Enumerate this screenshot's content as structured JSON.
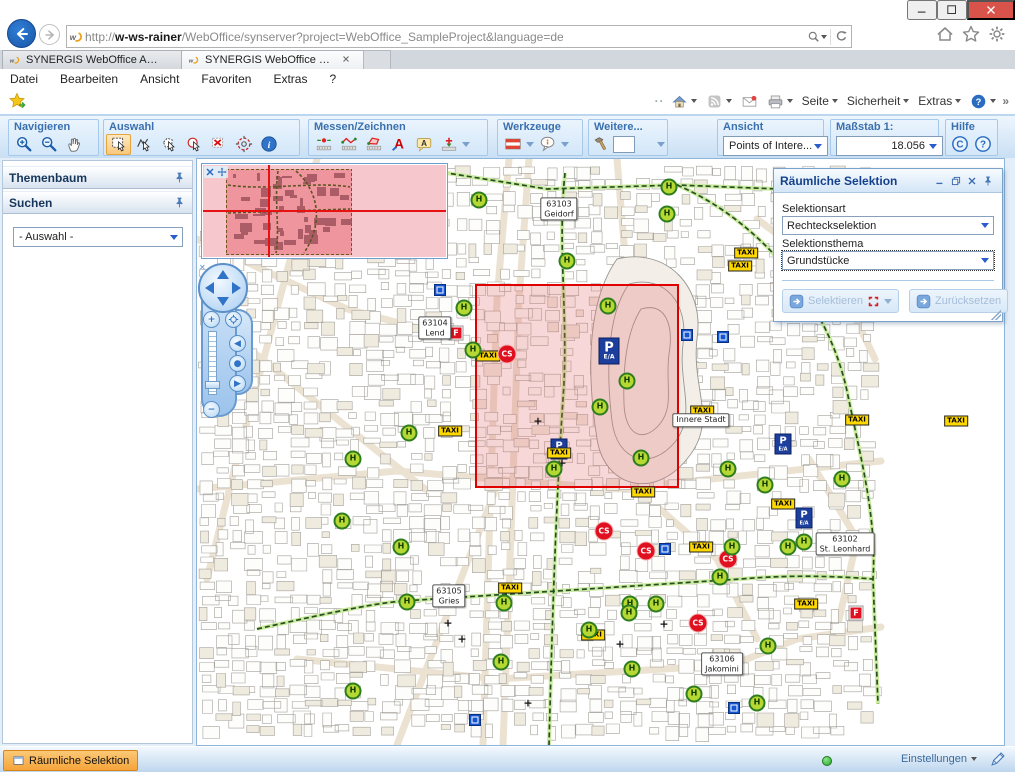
{
  "browser": {
    "url": {
      "scheme": "http://",
      "host": "w-ws-rainer",
      "path": "/WebOffice/synserver?project=WebOffice_SampleProject&language=de"
    },
    "tabs": [
      {
        "label": "SYNERGIS WebOffice Administ...",
        "active": false
      },
      {
        "label": "SYNERGIS WebOffice WebO...",
        "active": true
      }
    ],
    "menu": [
      "Datei",
      "Bearbeiten",
      "Ansicht",
      "Favoriten",
      "Extras",
      "?"
    ],
    "command_items": [
      {
        "icon": "home-icon",
        "caret": true
      },
      {
        "icon": "feeds-icon",
        "caret": true
      },
      {
        "icon": "read-mail-icon",
        "caret": false
      },
      {
        "icon": "print-icon",
        "caret": true
      },
      {
        "label": "Seite",
        "caret": true
      },
      {
        "label": "Sicherheit",
        "caret": true
      },
      {
        "label": "Extras",
        "caret": true
      },
      {
        "icon": "help-badge-icon",
        "caret": true
      }
    ],
    "overflow_chevron": "»",
    "drag_dots": "··"
  },
  "toolbar": {
    "groups": [
      {
        "label": "Navigieren",
        "icons": [
          {
            "name": "zoom-in-icon"
          },
          {
            "name": "zoom-out-icon"
          },
          {
            "name": "pan-icon"
          }
        ]
      },
      {
        "label": "Auswahl",
        "icons": [
          {
            "name": "select-rectangle-icon",
            "active": true
          },
          {
            "name": "select-line-icon"
          },
          {
            "name": "select-polygon-icon"
          },
          {
            "name": "select-circle-icon"
          },
          {
            "name": "select-clear-icon"
          },
          {
            "name": "select-buffer-icon"
          },
          {
            "name": "identify-icon"
          }
        ]
      },
      {
        "label": "Messen/Zeichnen",
        "icons": [
          {
            "name": "measure-point-icon"
          },
          {
            "name": "measure-line-icon"
          },
          {
            "name": "measure-area-icon"
          },
          {
            "name": "draw-text-icon"
          },
          {
            "name": "draw-label-icon"
          },
          {
            "name": "draw-symbol-icon",
            "caret": true
          }
        ]
      },
      {
        "label": "Werkzeuge",
        "icons": [
          {
            "name": "austria-flag-icon",
            "caret": true
          },
          {
            "name": "maptip-icon",
            "caret": true
          }
        ]
      },
      {
        "label": "Weitere...",
        "icons": [
          {
            "name": "hammer-icon"
          },
          {
            "name": "tool-text-input",
            "input": true
          },
          {
            "name": "more-tools",
            "caret": true
          }
        ]
      },
      {
        "label": "Ansicht",
        "dropdown": "Points of Intere..."
      },
      {
        "label": "Maßstab 1:",
        "dropdown": "18.056",
        "align": "right"
      },
      {
        "label": "Hilfe",
        "icons": [
          {
            "name": "copyright-icon"
          },
          {
            "name": "help-circle-icon"
          }
        ]
      }
    ]
  },
  "sidebar": {
    "panels": [
      "Themenbaum",
      "Suchen"
    ],
    "search_dropdown": "- Auswahl -"
  },
  "selection_panel": {
    "title": "Räumliche Selektion",
    "selektionsart_label": "Selektionsart",
    "selektionsart_value": "Rechteckselektion",
    "selektionsthema_label": "Selektionsthema",
    "selektionsthema_value": "Grundstücke",
    "select_button": "Selektieren",
    "reset_button": "Zurücksetzen"
  },
  "statusbar": {
    "active_tool_tab": "Räumliche Selektion",
    "settings": "Einstellungen"
  },
  "map": {
    "selection_rect": {
      "x": 279,
      "y": 126,
      "w": 202,
      "h": 202
    },
    "marker_labels": {
      "hydrant": "H",
      "taxi": "TAXI",
      "carsharing": "CS",
      "parking": "P",
      "parking_sub": "E/A",
      "fire": "F",
      "church": "+"
    },
    "districts": [
      {
        "x": 362,
        "y": 50,
        "lines": [
          "63103",
          "Geidorf"
        ]
      },
      {
        "x": 238,
        "y": 169,
        "lines": [
          "63104",
          "Lend"
        ]
      },
      {
        "x": 504,
        "y": 261,
        "lines": [
          "Innere Stadt"
        ]
      },
      {
        "x": 648,
        "y": 385,
        "lines": [
          "63102",
          "St. Leonhard"
        ]
      },
      {
        "x": 252,
        "y": 437,
        "lines": [
          "63105",
          "Gries"
        ]
      },
      {
        "x": 525,
        "y": 505,
        "lines": [
          "63106",
          "Jakomini"
        ]
      }
    ],
    "markers": {
      "hydrants": [
        [
          74,
          32
        ],
        [
          156,
          29
        ],
        [
          282,
          41
        ],
        [
          472,
          28
        ],
        [
          470,
          55
        ],
        [
          370,
          102
        ],
        [
          653,
          54
        ],
        [
          267,
          149
        ],
        [
          411,
          147
        ],
        [
          276,
          191
        ],
        [
          430,
          222
        ],
        [
          403,
          248
        ],
        [
          444,
          299
        ],
        [
          357,
          310
        ],
        [
          531,
          310
        ],
        [
          568,
          326
        ],
        [
          645,
          320
        ],
        [
          535,
          388
        ],
        [
          591,
          388
        ],
        [
          607,
          383
        ],
        [
          212,
          274
        ],
        [
          156,
          300
        ],
        [
          145,
          362
        ],
        [
          204,
          388
        ],
        [
          210,
          443
        ],
        [
          307,
          444
        ],
        [
          304,
          503
        ],
        [
          392,
          471
        ],
        [
          433,
          445
        ],
        [
          432,
          454
        ],
        [
          459,
          445
        ],
        [
          435,
          510
        ],
        [
          523,
          418
        ],
        [
          571,
          487
        ],
        [
          497,
          535
        ],
        [
          560,
          544
        ],
        [
          156,
          532
        ]
      ],
      "taxi": [
        [
          549,
          94
        ],
        [
          543,
          107
        ],
        [
          291,
          197
        ],
        [
          253,
          272
        ],
        [
          362,
          294
        ],
        [
          505,
          252
        ],
        [
          660,
          261
        ],
        [
          759,
          262
        ],
        [
          586,
          345
        ],
        [
          504,
          388
        ],
        [
          446,
          333
        ],
        [
          313,
          429
        ],
        [
          396,
          476
        ],
        [
          609,
          445
        ]
      ],
      "carsharing": [
        [
          310,
          195
        ],
        [
          407,
          372
        ],
        [
          449,
          392
        ],
        [
          531,
          400
        ],
        [
          501,
          464
        ]
      ],
      "parking": [
        {
          "x": 412,
          "y": 192,
          "large": true
        },
        {
          "x": 362,
          "y": 290
        },
        {
          "x": 586,
          "y": 285
        },
        {
          "x": 607,
          "y": 359
        }
      ],
      "fire": [
        [
          259,
          174
        ],
        [
          659,
          454
        ]
      ],
      "info_squares": [
        [
          243,
          131
        ],
        [
          490,
          176
        ],
        [
          526,
          178
        ],
        [
          468,
          390
        ],
        [
          278,
          561
        ],
        [
          537,
          549
        ]
      ],
      "churches": [
        [
          341,
          262
        ],
        [
          365,
          304
        ],
        [
          251,
          464
        ],
        [
          265,
          480
        ],
        [
          467,
          465
        ],
        [
          423,
          485
        ],
        [
          331,
          544
        ]
      ]
    },
    "colors": {
      "selection_fill": "rgba(228,110,110,0.28)",
      "selection_border": "#e00000"
    }
  }
}
